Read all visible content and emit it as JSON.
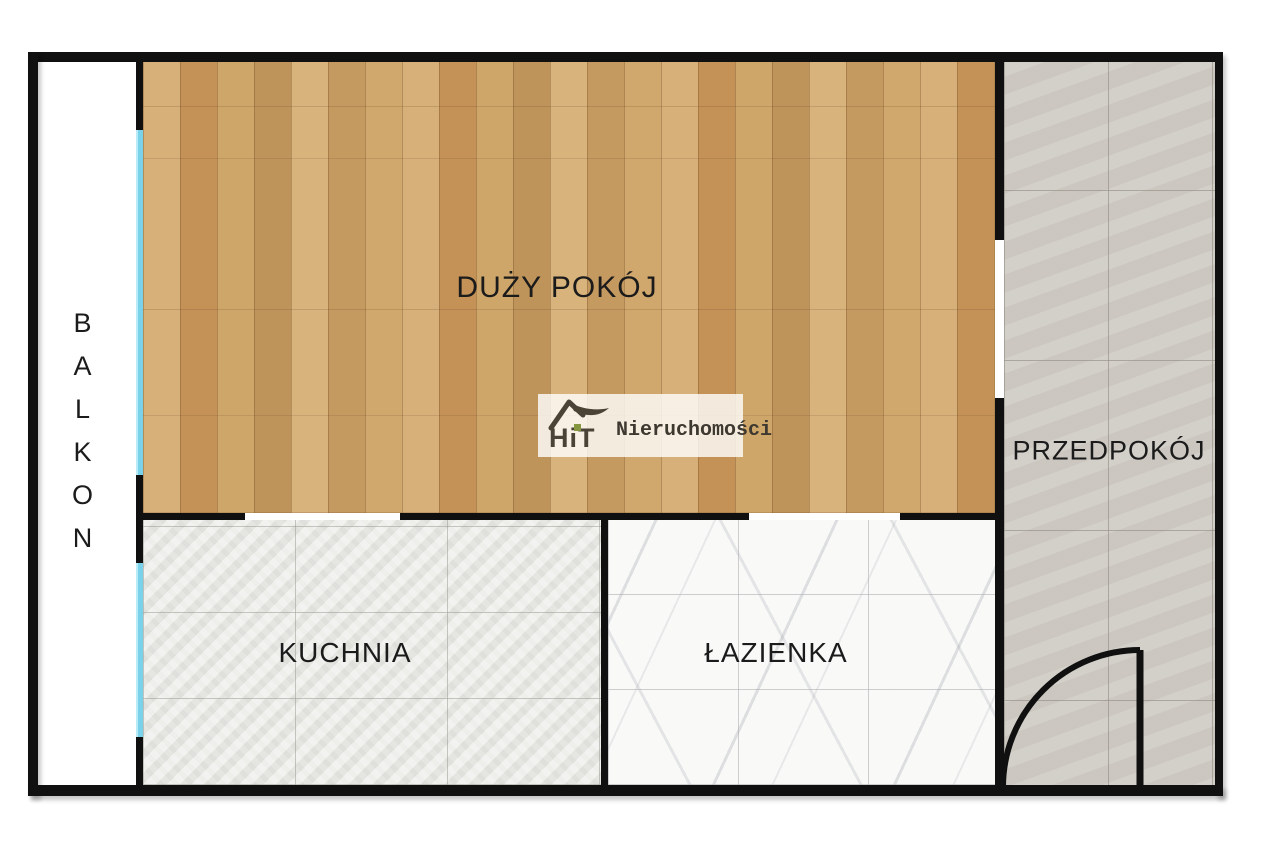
{
  "title": "Rzut mieszkania",
  "rooms": {
    "living": {
      "label": "DUŻY POKÓJ",
      "floor": "wood"
    },
    "kitchen": {
      "label": "KUCHNIA",
      "floor": "light-grey-tile"
    },
    "bathroom": {
      "label": "ŁAZIENKA",
      "floor": "white-marble-tile"
    },
    "hallway": {
      "label": "PRZEDPOKÓJ",
      "floor": "grey-tile"
    },
    "balcony": {
      "label": "BALKON",
      "floor": "none"
    }
  },
  "logo": {
    "brand": "HiT",
    "subtitle": "Nieruchomości"
  },
  "colors": {
    "wall": "#101010",
    "window": "#79d2e9",
    "wood": "#cda268",
    "kitchen_tile": "#ebebe8",
    "bath_tile": "#f9f9f8",
    "hall_tile": "#d0ccc5",
    "logo_brown": "#4b4336",
    "logo_green": "#86953f"
  }
}
